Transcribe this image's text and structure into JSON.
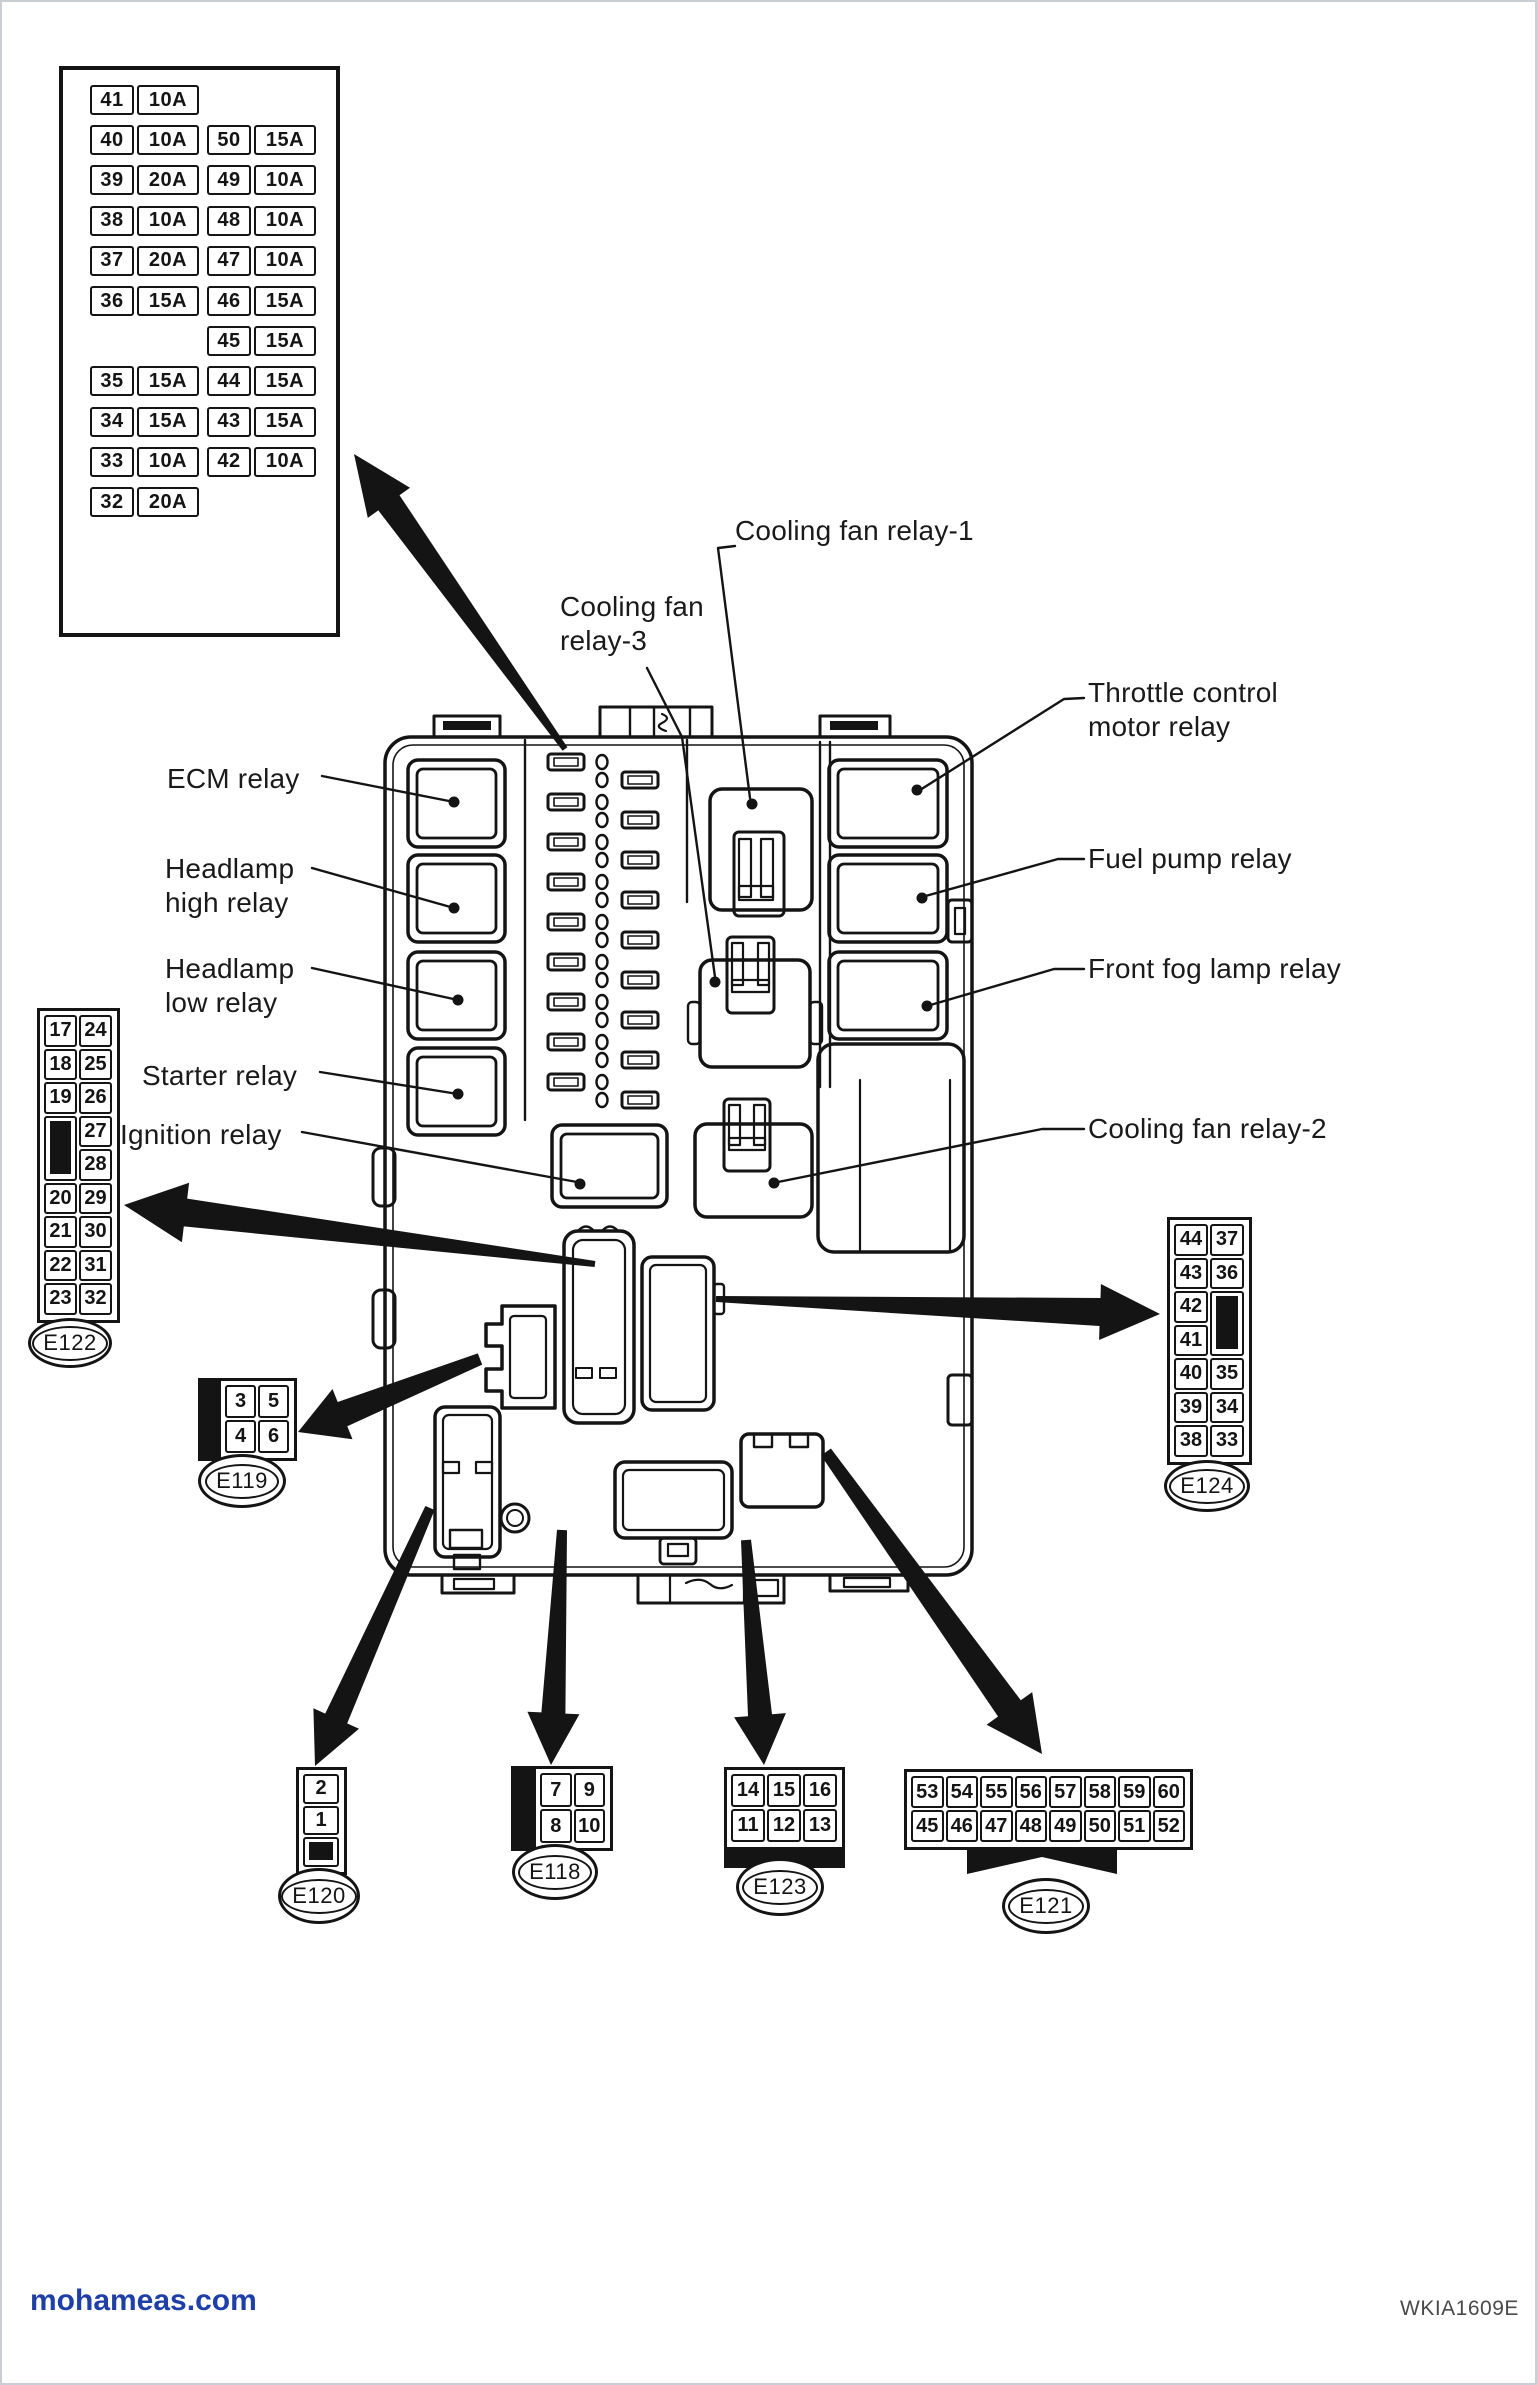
{
  "fuse_table": {
    "left": [
      {
        "slot": 0,
        "no": "41",
        "amp": "10A"
      },
      {
        "slot": 1,
        "no": "40",
        "amp": "10A"
      },
      {
        "slot": 2,
        "no": "39",
        "amp": "20A"
      },
      {
        "slot": 3,
        "no": "38",
        "amp": "10A"
      },
      {
        "slot": 4,
        "no": "37",
        "amp": "20A"
      },
      {
        "slot": 5,
        "no": "36",
        "amp": "15A"
      },
      {
        "slot": 7,
        "no": "35",
        "amp": "15A"
      },
      {
        "slot": 8,
        "no": "34",
        "amp": "15A"
      },
      {
        "slot": 9,
        "no": "33",
        "amp": "10A"
      },
      {
        "slot": 10,
        "no": "32",
        "amp": "20A"
      }
    ],
    "right": [
      {
        "slot": 1,
        "no": "50",
        "amp": "15A"
      },
      {
        "slot": 2,
        "no": "49",
        "amp": "10A"
      },
      {
        "slot": 3,
        "no": "48",
        "amp": "10A"
      },
      {
        "slot": 4,
        "no": "47",
        "amp": "10A"
      },
      {
        "slot": 5,
        "no": "46",
        "amp": "15A"
      },
      {
        "slot": 6,
        "no": "45",
        "amp": "15A"
      },
      {
        "slot": 7,
        "no": "44",
        "amp": "15A"
      },
      {
        "slot": 8,
        "no": "43",
        "amp": "15A"
      },
      {
        "slot": 9,
        "no": "42",
        "amp": "10A"
      }
    ]
  },
  "labels": {
    "ecm": "ECM relay",
    "headlamp_high": "Headlamp\nhigh relay",
    "headlamp_low": "Headlamp\nlow relay",
    "starter": "Starter relay",
    "ignition": "Ignition relay",
    "cooling_fan_3": "Cooling fan\nrelay-3",
    "cooling_fan_1": "Cooling fan relay-1",
    "throttle": "Throttle control\nmotor relay",
    "fuel_pump": "Fuel pump relay",
    "front_fog": "Front fog lamp relay",
    "cooling_fan_2": "Cooling fan relay-2"
  },
  "connectors": {
    "e122": {
      "label": "E122",
      "grid": [
        [
          "17",
          "24"
        ],
        [
          "18",
          "25"
        ],
        [
          "19",
          "26"
        ],
        [
          "#",
          "27"
        ],
        [
          "#",
          "28"
        ],
        [
          "20",
          "29"
        ],
        [
          "21",
          "30"
        ],
        [
          "22",
          "31"
        ],
        [
          "23",
          "32"
        ]
      ],
      "black_bar": {
        "col": 0,
        "from": 3,
        "to": 4
      }
    },
    "e124": {
      "label": "E124",
      "grid": [
        [
          "44",
          "37"
        ],
        [
          "43",
          "36"
        ],
        [
          "42",
          "#"
        ],
        [
          "41",
          "#"
        ],
        [
          "40",
          "35"
        ],
        [
          "39",
          "34"
        ],
        [
          "38",
          "33"
        ]
      ],
      "black_bar": {
        "col": 1,
        "from": 2,
        "to": 3
      }
    },
    "e119": {
      "label": "E119",
      "grid": [
        [
          "3",
          "5"
        ],
        [
          "4",
          "6"
        ]
      ],
      "strip": "left"
    },
    "e120": {
      "label": "E120",
      "grid": [
        [
          "2"
        ],
        [
          "1"
        ],
        [
          "#"
        ]
      ],
      "black_bar": {
        "col": 0,
        "from": 2,
        "to": 2
      }
    },
    "e118": {
      "label": "E118",
      "grid": [
        [
          "7",
          "9"
        ],
        [
          "8",
          "10"
        ]
      ],
      "strip": "left"
    },
    "e123": {
      "label": "E123",
      "grid": [
        [
          "14",
          "15",
          "16"
        ],
        [
          "11",
          "12",
          "13"
        ]
      ],
      "strip": "bottom"
    },
    "e121": {
      "label": "E121",
      "grid": [
        [
          "53",
          "54",
          "55",
          "56",
          "57",
          "58",
          "59",
          "60"
        ],
        [
          "45",
          "46",
          "47",
          "48",
          "49",
          "50",
          "51",
          "52"
        ]
      ]
    }
  },
  "footer": {
    "site": "mohameas.com",
    "code": "WKIA1609E"
  }
}
